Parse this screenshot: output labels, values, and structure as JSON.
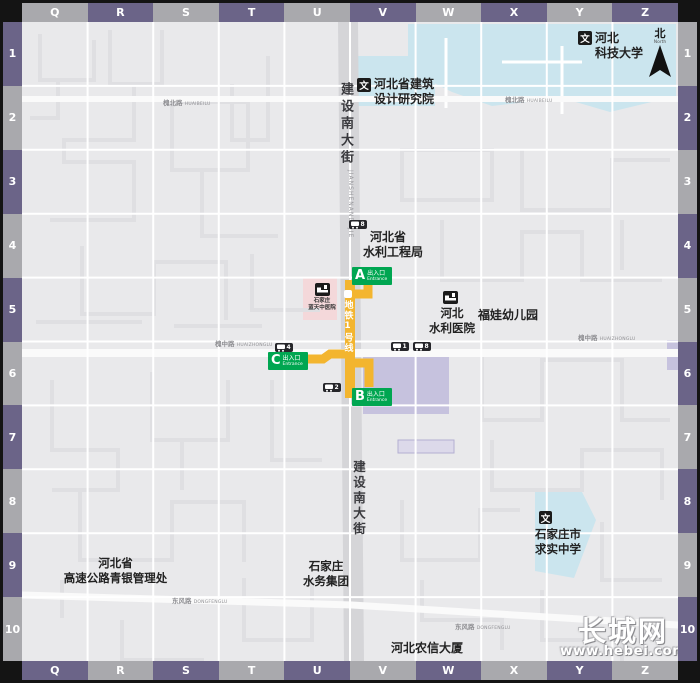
{
  "grid": {
    "top_letters": [
      "Q",
      "R",
      "S",
      "T",
      "U",
      "V",
      "W",
      "X",
      "Y",
      "Z"
    ],
    "bottom_letters": [
      "Q",
      "R",
      "S",
      "T",
      "U",
      "V",
      "W",
      "X",
      "Y",
      "Z"
    ],
    "left_numbers": [
      "1",
      "2",
      "3",
      "4",
      "5",
      "6",
      "7",
      "8",
      "9",
      "10"
    ],
    "right_numbers": [
      "1",
      "2",
      "3",
      "4",
      "5",
      "6",
      "7",
      "8",
      "9",
      "10"
    ]
  },
  "compass": {
    "north_cn": "北",
    "north_en": "North"
  },
  "icons": {
    "culture": "文"
  },
  "metro": {
    "line_label": "地铁1号线"
  },
  "entrances": {
    "a": {
      "letter": "A",
      "cn": "出入口",
      "en": "Entrance"
    },
    "b": {
      "letter": "B",
      "cn": "出入口",
      "en": "Entrance"
    },
    "c": {
      "letter": "C",
      "cn": "出入口",
      "en": "Entrance"
    }
  },
  "pois": {
    "university": {
      "line1": "河北",
      "line2": "科技大学"
    },
    "design_institute": {
      "line1": "河北省建筑",
      "line2": "设计研究院"
    },
    "water_bureau": {
      "line1": "河北省",
      "line2": "水利工程局"
    },
    "water_hospital": {
      "line1": "河北",
      "line2": "水利医院"
    },
    "kindergarten": {
      "line1": "福娃幼儿园"
    },
    "lantian_hospital": {
      "line1": "石家庄",
      "line2": "蓝天中医院"
    },
    "expressway_admin": {
      "line1": "河北省",
      "line2": "高速公路青银管理处"
    },
    "water_group": {
      "line1": "石家庄",
      "line2": "水务集团"
    },
    "qiushi_school": {
      "line1": "石家庄市",
      "line2": "求实中学"
    },
    "rural_credit": {
      "line1": "河北农信大厦"
    }
  },
  "roads": {
    "main_top": "建设南大街",
    "main_pinyin": "JIANSHENANDAJIE",
    "main_bottom": "建设南大街",
    "huaibei_cn": "槐北路",
    "huaibei_en": "HUAIBEILU",
    "huaizhong_cn": "槐中路",
    "huaizhong_en": "HUAIZHONGLU",
    "dongfeng_cn": "东风路",
    "dongfeng_en": "DONGFENGLU"
  },
  "bus_stops": [
    {
      "route": "8"
    },
    {
      "route": "1"
    },
    {
      "route": "8"
    },
    {
      "route": "4"
    },
    {
      "route": "2"
    }
  ],
  "watermark": {
    "brand": "长城网",
    "url": "www.hebei.com.cn"
  },
  "colors": {
    "metro_yellow": "#f3b52f",
    "entrance_green": "#00a651",
    "bar_purple": "#6b6488",
    "bar_gray": "#a9a9ad",
    "campus_blue": "#cbe5ee",
    "building_purple": "#c6c2de",
    "hospital_pink": "#f4d8da"
  }
}
